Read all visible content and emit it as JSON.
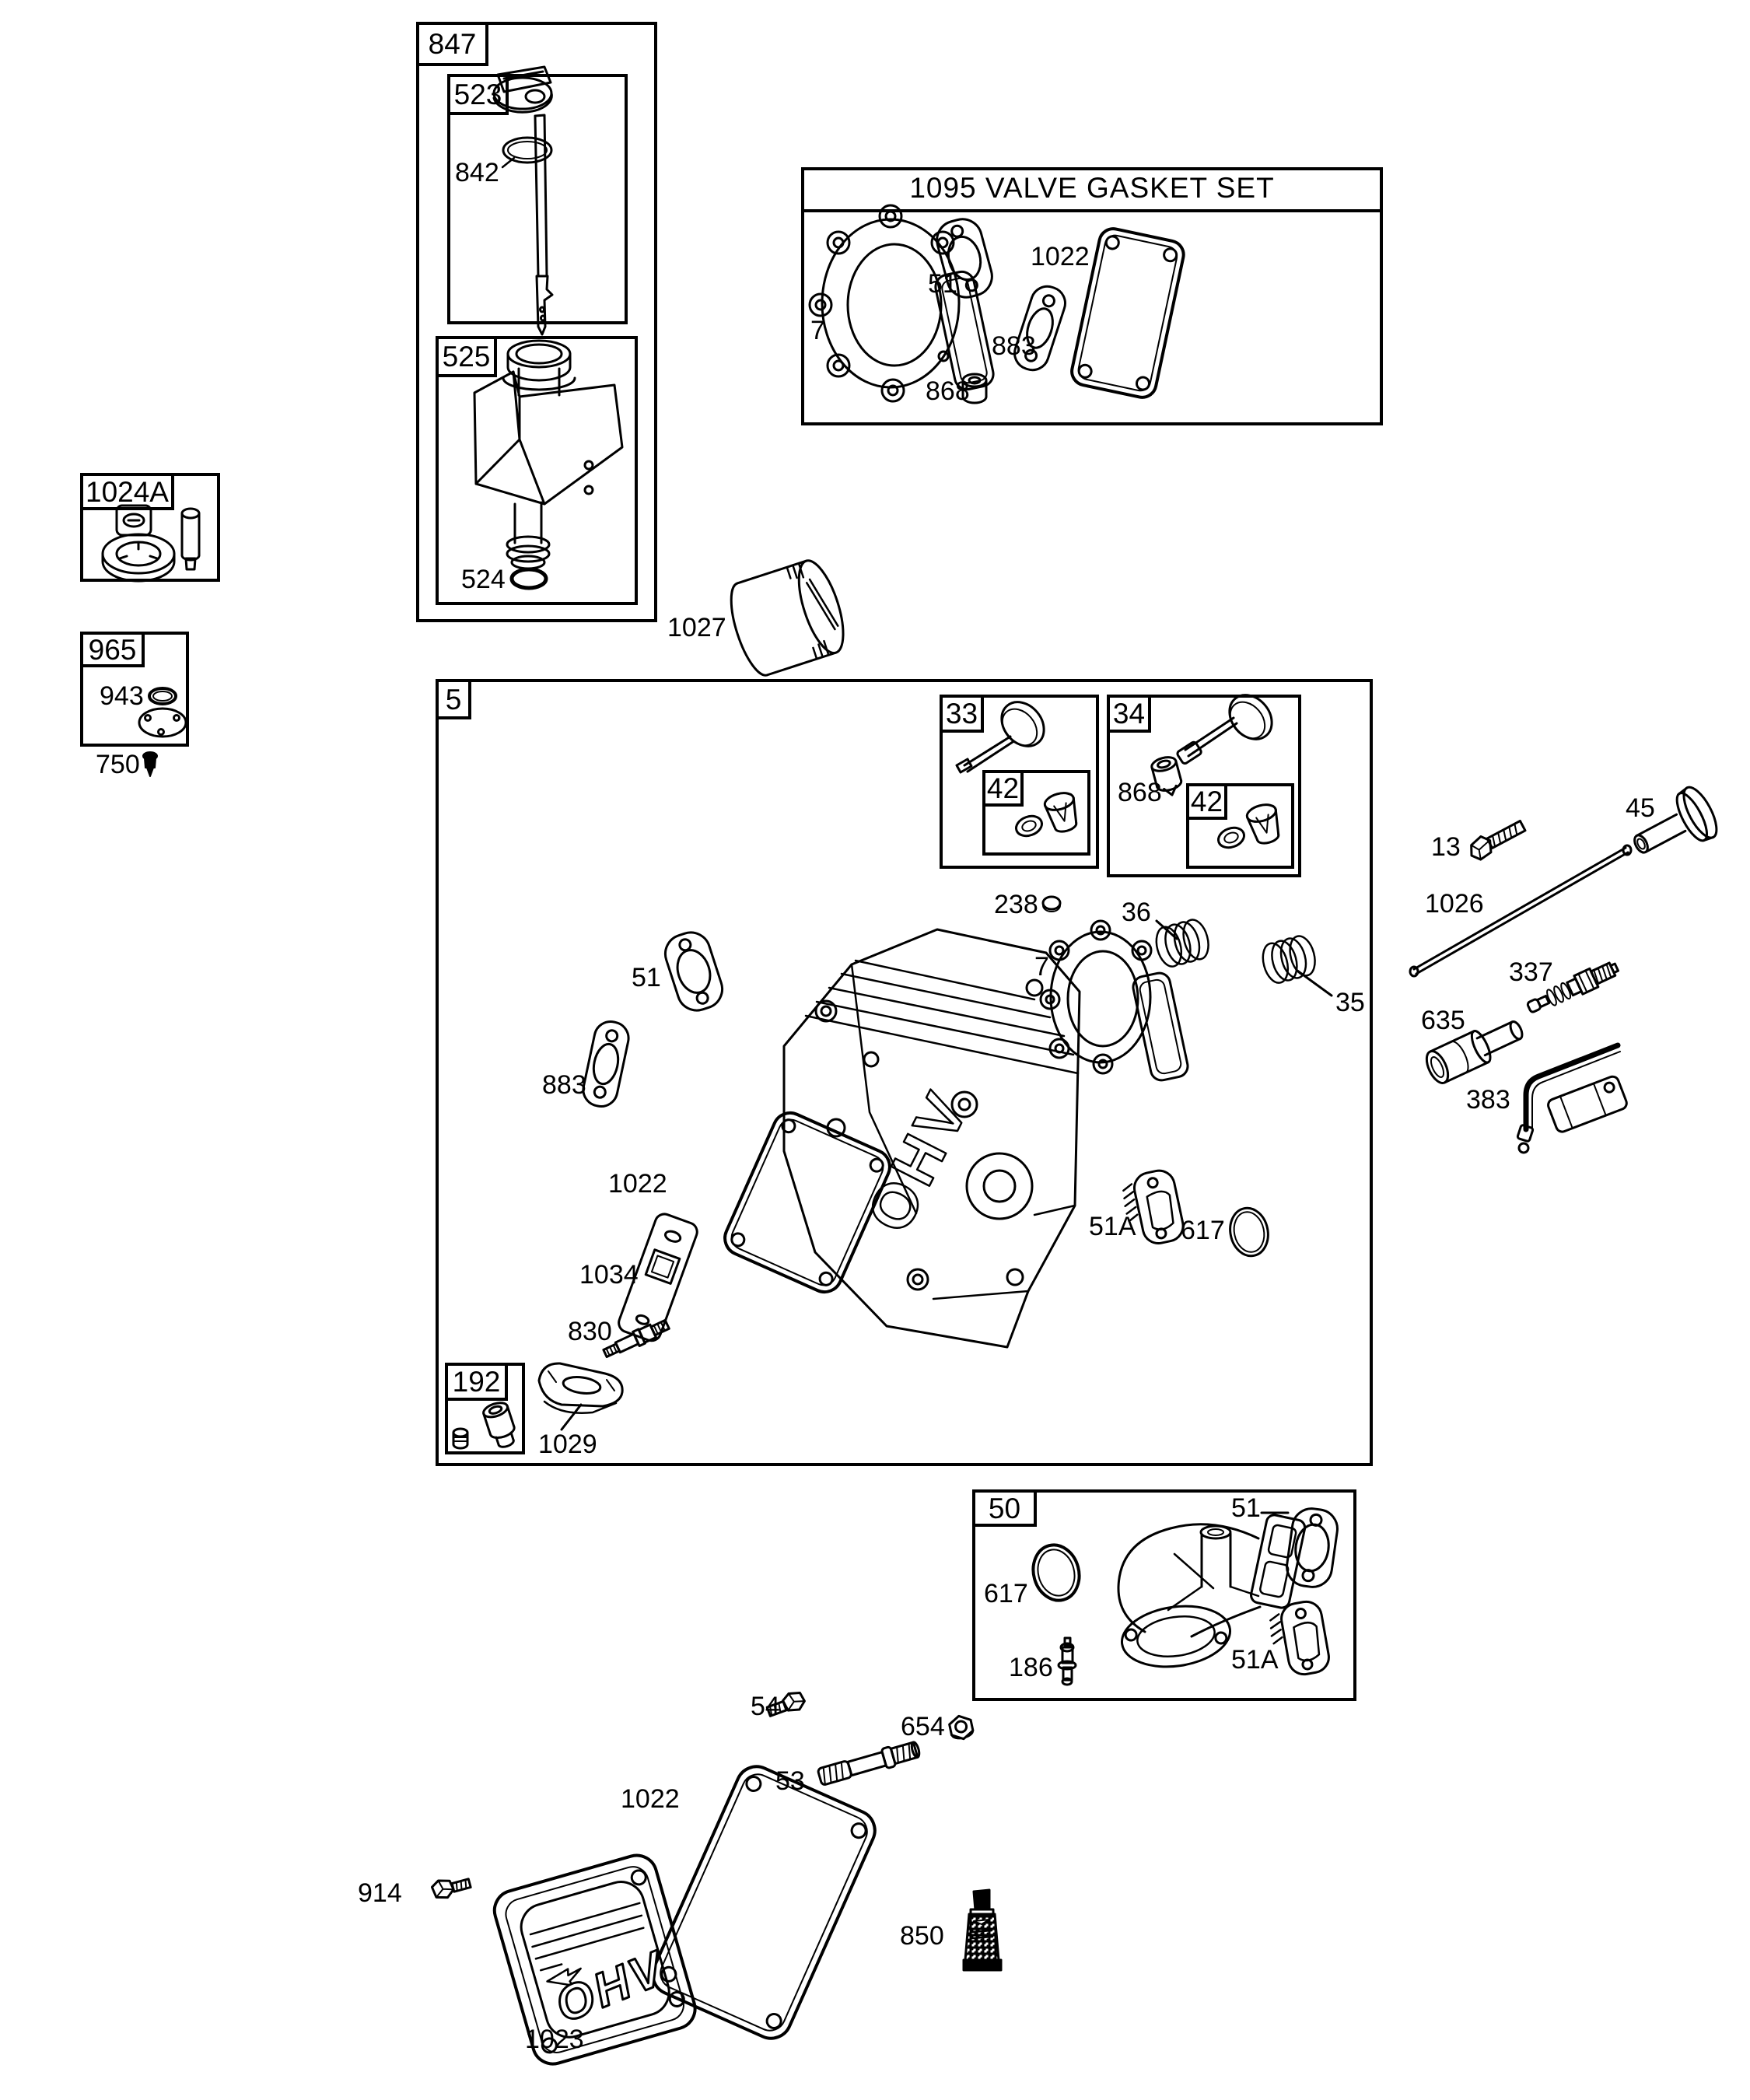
{
  "title_box": {
    "title": "1095 VALVE GASKET SET"
  },
  "group_labels": {
    "g847": "847",
    "g523": "523",
    "g525": "525",
    "g1024a": "1024A",
    "g965": "965",
    "g5": "5",
    "g33": "33",
    "g34": "34",
    "g42_intake": "42",
    "g42_exhaust": "42",
    "g192": "192",
    "g50": "50"
  },
  "part_labels": {
    "p842": "842",
    "p524": "524",
    "p943": "943",
    "p750": "750",
    "gs7": "7",
    "gs51": "51",
    "gs868": "868",
    "gs883": "883",
    "gs1022": "1022",
    "p1027": "1027",
    "v868": "868",
    "p238": "238",
    "p36": "36",
    "p35": "35",
    "h51": "51",
    "h883": "883",
    "h7": "7",
    "h1022": "1022",
    "p1034": "1034",
    "p830": "830",
    "p1029": "1029",
    "h51a": "51A",
    "h617": "617",
    "p13": "13",
    "p45": "45",
    "p1026": "1026",
    "p337": "337",
    "p635": "635",
    "p383": "383",
    "m617": "617",
    "m186": "186",
    "m51": "51",
    "m51a": "51A",
    "p54": "54",
    "p654": "654",
    "p53": "53",
    "c1022": "1022",
    "p914": "914",
    "p1023": "1023",
    "p850": "850"
  },
  "artwork_text": {
    "head_ohv": "OHV",
    "cover_ohv": "OHV"
  }
}
